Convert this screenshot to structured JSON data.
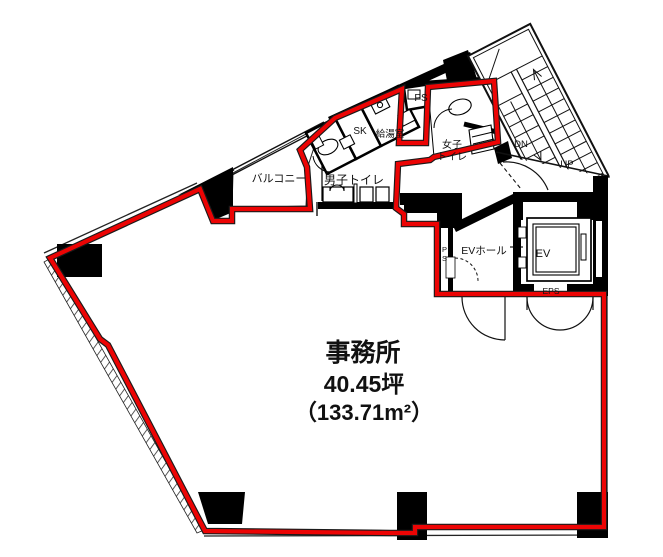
{
  "plan": {
    "office": {
      "name": "事務所",
      "area_tsubo": "40.45坪",
      "area_sqm": "（133.71m²）"
    },
    "rooms": {
      "balcony": "バルコニー",
      "mens_toilet": "男子トイレ",
      "womens_toilet_line1": "女子",
      "womens_toilet_line2": "トイレ",
      "sink_closet": "SK",
      "kitchenette": "給湯室",
      "pipe_space_top": "PS",
      "pipe_space_wall": {
        "p": "P",
        "s": "S"
      },
      "ev_hall": "EVホール",
      "elevator": "EV",
      "eps": "EPS"
    },
    "stairs": {
      "down": "DN",
      "up": "UP"
    },
    "colors": {
      "boundary_red": "#ec0404",
      "wall_black": "#000000",
      "background": "#ffffff"
    }
  }
}
